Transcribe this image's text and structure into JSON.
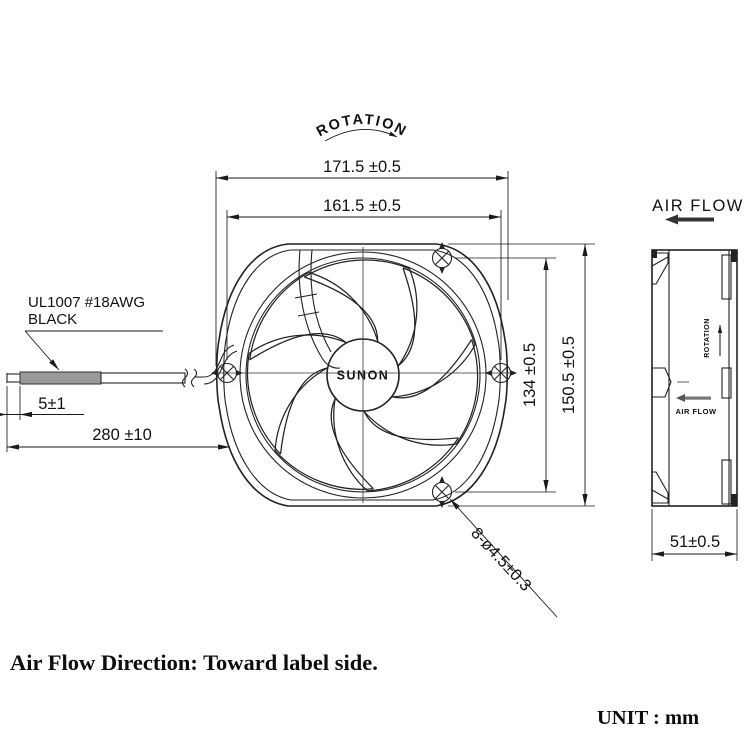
{
  "front_view": {
    "rotation_label": "ROTATION",
    "hub_label": "SUNON",
    "dim_width": "171.5 ±0.5",
    "dim_hole_span": "161.5 ±0.5",
    "dim_hole_span_v": "134 ±0.5",
    "dim_height": "150.5 ±0.5",
    "dim_holes": "8-ø4.5±0.3",
    "wire_label1": "UL1007 #18AWG",
    "wire_label2": "BLACK",
    "dim_strip": "5±1",
    "dim_wire_len": "280 ±10"
  },
  "side_view": {
    "air_flow_label": "AIR FLOW",
    "rotation_label": "ROTATION",
    "air_flow_inner_label": "AIR FLOW",
    "dim_depth": "51±0.5"
  },
  "footer": {
    "note": "Air Flow Direction: Toward label side.",
    "unit": "UNIT : mm"
  },
  "colors": {
    "line": "#222222",
    "wire_gray": "#9a9a9a",
    "background": "#ffffff"
  }
}
